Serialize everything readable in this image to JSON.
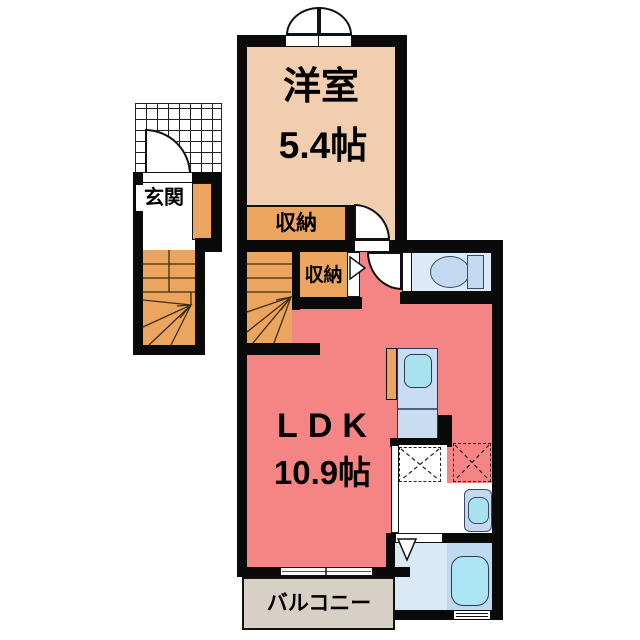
{
  "plan": {
    "type": "apartment-floor-plan",
    "rooms": {
      "western_room": {
        "label": "洋室",
        "size": "5.4帖"
      },
      "ldk": {
        "label": "LDK",
        "size": "10.9帖"
      },
      "entrance": {
        "label": "玄関"
      },
      "closet_upper": {
        "label": "収納"
      },
      "closet_lower": {
        "label": "収納"
      },
      "balcony": {
        "label": "バルコニー"
      }
    },
    "colors": {
      "wall": "#0A0A0A",
      "western_room": "#F2CEB1",
      "closet_stairs": "#EBA55E",
      "ldk": "#F58585",
      "sanitary_room": "#DCEAF7",
      "fixture": "#C3D9F1",
      "water": "#A9E2EF",
      "bath_floor": "#D9E9F6",
      "tub_area": "#BFD9EF",
      "balcony": "#D7D0C6"
    }
  }
}
